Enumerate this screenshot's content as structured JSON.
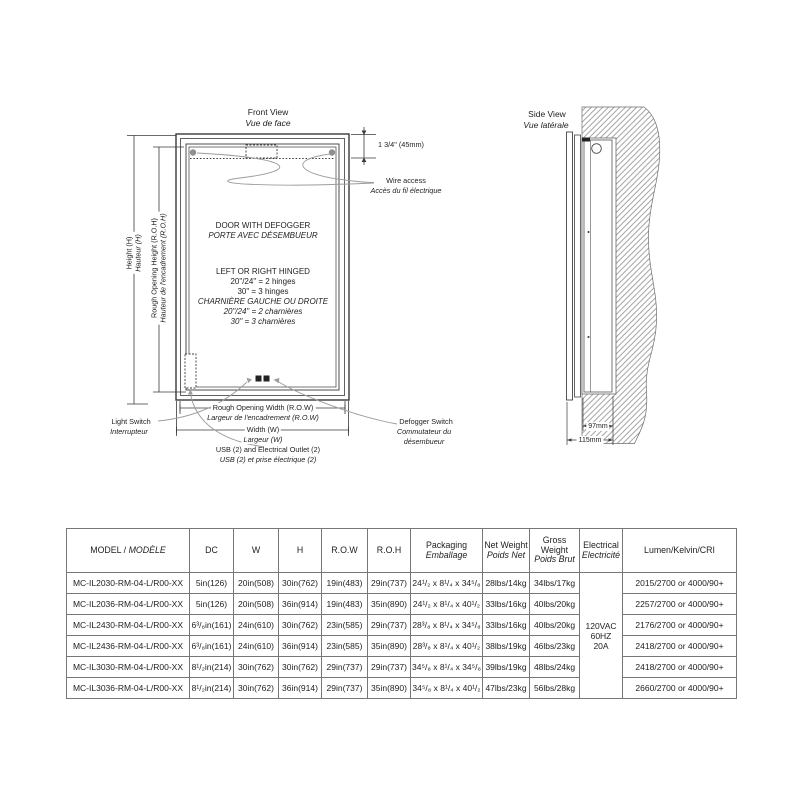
{
  "front_view": {
    "title_en": "Front View",
    "title_fr": "Vue de face",
    "top_dim": "1 3/4\" (45mm)",
    "wire_access_en": "Wire access",
    "wire_access_fr": "Accès du fil électrique",
    "door_line1": "DOOR WITH DEFOGGER",
    "door_line2": "PORTE AVEC DÉSEMBUEUR",
    "hinge_line1": "LEFT OR RIGHT HINGED",
    "hinge_line2": "20\"/24\" = 2 hinges",
    "hinge_line3": "30\" = 3 hinges",
    "hinge_line4": "CHARNIÈRE GAUCHE OU DROITE",
    "hinge_line5": "20\"/24\" = 2 charnières",
    "hinge_line6": "30\" = 3 charnières",
    "height_en": "Height (H)",
    "height_fr": "Hauteur (H)",
    "roh_en": "Rough Opening Height (R.O.H)",
    "roh_fr": "Hauteur de l'encadrement (R.O.H)",
    "row_en": "Rough Opening Width (R.O.W)",
    "row_fr": "Largeur de l'encadrement (R.O.W)",
    "width_en": "Width (W)",
    "width_fr": "Largeur (W)",
    "light_switch_en": "Light Switch",
    "light_switch_fr": "Interrupteur",
    "defogger_en": "Defogger Switch",
    "defogger_fr1": "Commutateur du",
    "defogger_fr2": "désembueur",
    "usb_en": "USB (2) and Electrical Outlet (2)",
    "usb_fr": "USB (2) et prise électrique (2)"
  },
  "side_view": {
    "title_en": "Side View",
    "title_fr": "Vue latérale",
    "dim_recessed": "97mm",
    "dim_total": "115mm"
  },
  "table": {
    "headers": {
      "model_en": "MODEL / ",
      "model_fr": "MODÈLE",
      "dc": "DC",
      "w": "W",
      "h": "H",
      "row": "R.O.W",
      "roh": "R.O.H",
      "pack_en": "Packaging",
      "pack_fr": "Emballage",
      "net_en": "Net Weight",
      "net_fr": "Poids Net",
      "gross_en": "Gross Weight",
      "gross_fr": "Poids Brut",
      "elec_en": "Electrical",
      "elec_fr": "Electricité",
      "lumen": "Lumen/Kelvin/CRI"
    },
    "electrical": {
      "l1": "120VAC",
      "l2": "60HZ",
      "l3": "20A"
    },
    "rows": [
      {
        "model": "MC-IL2030-RM-04-L/R00-XX",
        "dc": "5in(126)",
        "w": "20in(508)",
        "h": "30in(762)",
        "row": "19in(483)",
        "roh": "29in(737)",
        "pack": "24¹/₂ x 8¹/₄ x 34⁵/₈",
        "net": "28lbs/14kg",
        "gross": "34lbs/17kg",
        "lumen": "2015/2700 or 4000/90+"
      },
      {
        "model": "MC-IL2036-RM-04-L/R00-XX",
        "dc": "5in(126)",
        "w": "20in(508)",
        "h": "36in(914)",
        "row": "19in(483)",
        "roh": "35in(890)",
        "pack": "24¹/₂ x 8¹/₄ x 40¹/₂",
        "net": "33lbs/16kg",
        "gross": "40lbs/20kg",
        "lumen": "2257/2700 or 4000/90+"
      },
      {
        "model": "MC-IL2430-RM-04-L/R00-XX",
        "dc": "6³/₈in(161)",
        "w": "24in(610)",
        "h": "30in(762)",
        "row": "23in(585)",
        "roh": "29in(737)",
        "pack": "28³/₈ x 8¹/₄ x 34⁵/₈",
        "net": "33lbs/16kg",
        "gross": "40lbs/20kg",
        "lumen": "2176/2700 or 4000/90+"
      },
      {
        "model": "MC-IL2436-RM-04-L/R00-XX",
        "dc": "6³/₈in(161)",
        "w": "24in(610)",
        "h": "36in(914)",
        "row": "23in(585)",
        "roh": "35in(890)",
        "pack": "28³/₈ x 8¹/₄ x 40¹/₂",
        "net": "38lbs/19kg",
        "gross": "46lbs/23kg",
        "lumen": "2418/2700 or 4000/90+"
      },
      {
        "model": "MC-IL3030-RM-04-L/R00-XX",
        "dc": "8¹/₂in(214)",
        "w": "30in(762)",
        "h": "30in(762)",
        "row": "29in(737)",
        "roh": "29in(737)",
        "pack": "34⁵/₈ x 8¹/₄ x 34⁵/₈",
        "net": "39lbs/19kg",
        "gross": "48lbs/24kg",
        "lumen": "2418/2700 or 4000/90+"
      },
      {
        "model": "MC-IL3036-RM-04-L/R00-XX",
        "dc": "8¹/₂in(214)",
        "w": "30in(762)",
        "h": "36in(914)",
        "row": "29in(737)",
        "roh": "35in(890)",
        "pack": "34⁵/₈ x 8¹/₄ x 40¹/₂",
        "net": "47lbs/23kg",
        "gross": "56lbs/28kg",
        "lumen": "2660/2700 or 4000/90+"
      }
    ]
  }
}
